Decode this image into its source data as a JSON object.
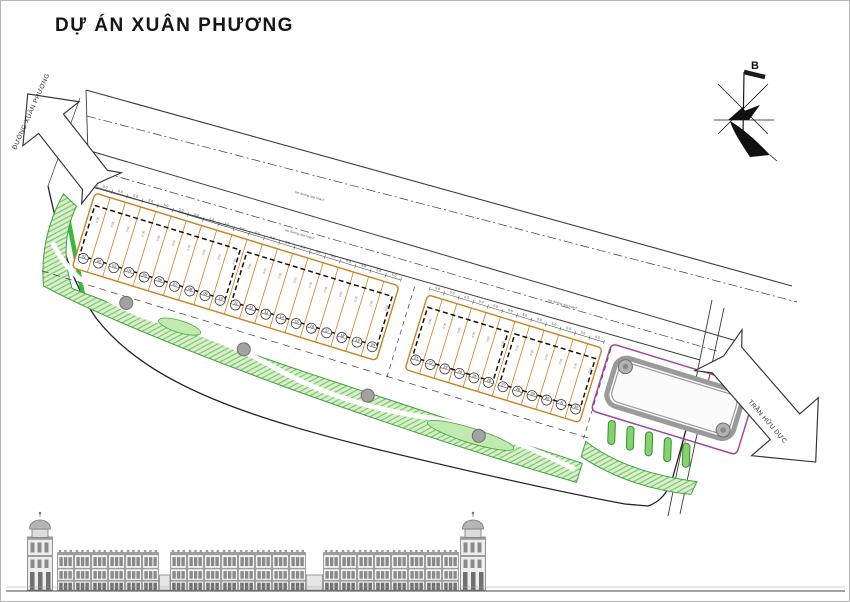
{
  "title": "DỰ ÁN XUÂN PHƯƠNG",
  "compass": {
    "north_label": "B"
  },
  "roads": {
    "left_arrow_label": "ĐƯỜNG XUÂN PHƯƠNG",
    "right_arrow_label": "TRẦN HỮU DỰC",
    "centerline_label": "tim đường quy hoạch",
    "channel_label": "mương thoát nước"
  },
  "lots": {
    "width_label": "5.0",
    "area_label": "50.0",
    "rows": [
      {
        "name": "row-1",
        "start_no": 1,
        "count": 20,
        "clusters": [
          [
            0,
            10
          ],
          [
            10,
            20
          ]
        ]
      },
      {
        "name": "row-2",
        "start_no": 21,
        "count": 12,
        "clusters": [
          [
            0,
            6
          ],
          [
            6,
            12
          ]
        ]
      }
    ]
  },
  "landscape": {
    "tree_count": 4,
    "parking_stall_count": 5
  },
  "elevation": {
    "tower_positions": [
      25,
      458
    ],
    "groups": [
      {
        "x": 57,
        "units": 6
      },
      {
        "x": 170,
        "units": 8
      },
      {
        "x": 323,
        "units": 8
      }
    ]
  },
  "colors": {
    "line": "#2a2a2a",
    "lot_line": "#c8821e",
    "green_stroke": "#3da23d",
    "green_fill": "#d9efcd",
    "hatch_line": "#74c261",
    "bright_green": "#3cb93c",
    "tree_gray": "#a2a2a2",
    "pond_gray": "#9a9a9a",
    "purple": "#a344a3",
    "elev_gray": "#8a8a8a"
  }
}
